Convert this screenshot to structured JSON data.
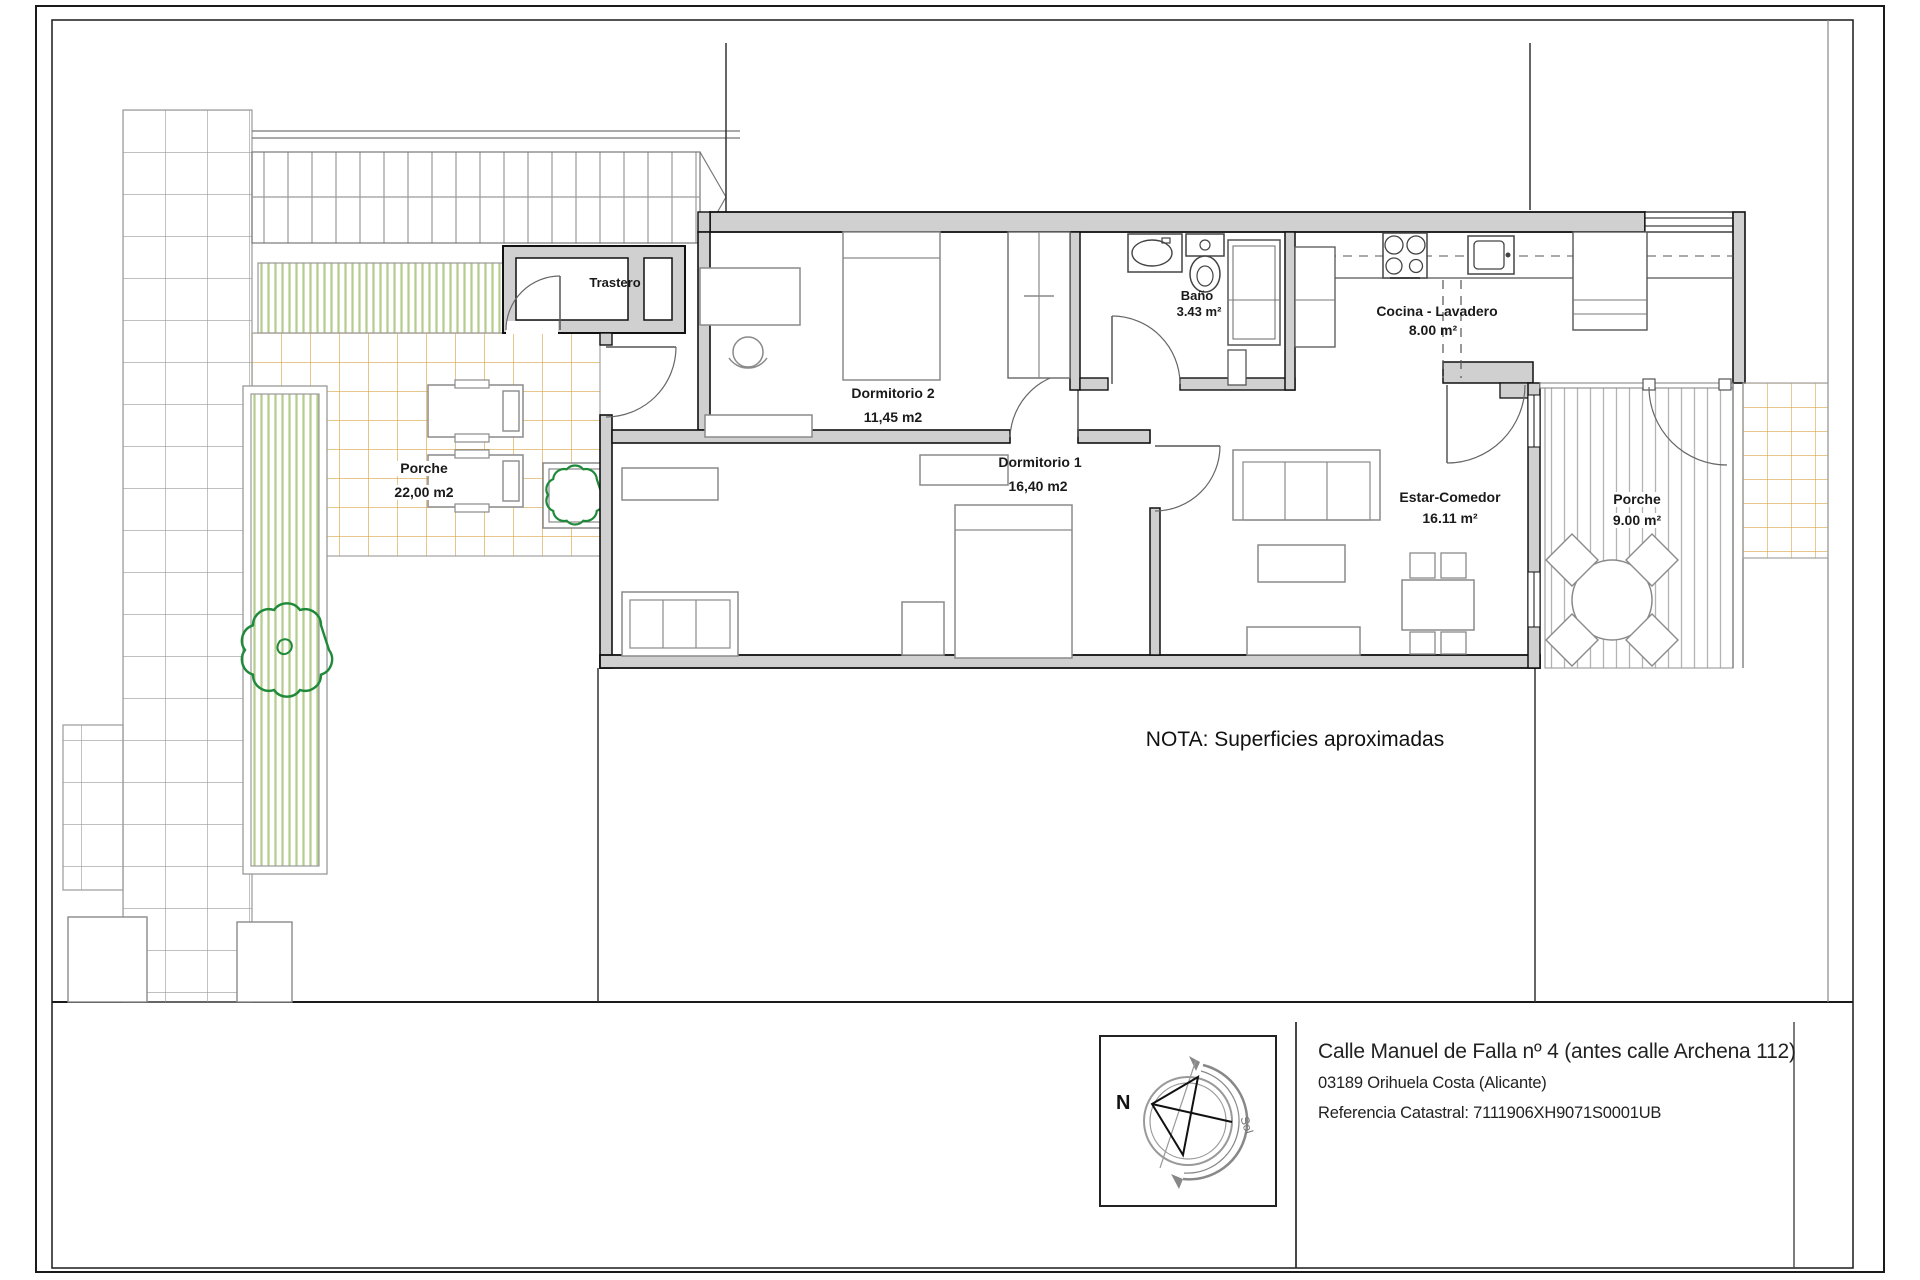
{
  "plan": {
    "rooms": {
      "trastero": {
        "name": "Trastero",
        "area": ""
      },
      "bano": {
        "name": "Baño",
        "area": "3.43 m²"
      },
      "cocina": {
        "name": "Cocina - Lavadero",
        "area": "8.00 m²"
      },
      "dormitorio2": {
        "name": "Dormitorio 2",
        "area": "11,45 m2"
      },
      "dormitorio1": {
        "name": "Dormitorio 1",
        "area": "16,40 m2"
      },
      "estar": {
        "name": "Estar-Comedor",
        "area": "16.11 m²"
      },
      "porche_izquierdo": {
        "name": "Porche",
        "area": "22,00 m2"
      },
      "porche_derecho": {
        "name": "Porche",
        "area": "9.00 m²"
      }
    },
    "note": "NOTA: Superficies aproximadas"
  },
  "title_block": {
    "address_line1": "Calle Manuel de Falla nº 4 (antes calle Archena 112)",
    "address_line2": "03189 Orihuela Costa (Alicante)",
    "address_line3": "Referencia Catastral: 7111906XH9071S0001UB",
    "compass": {
      "north_label": "N",
      "sun_label": "Sol"
    }
  },
  "colors": {
    "wall_fill": "#d0d0d0",
    "tile_grid_orange": "#d8a84b",
    "greenery_stripe": "#b4cc8c",
    "tree_outline": "#1f8a3a",
    "line_dark": "#111111",
    "furniture_gray": "#8a8a8a"
  }
}
